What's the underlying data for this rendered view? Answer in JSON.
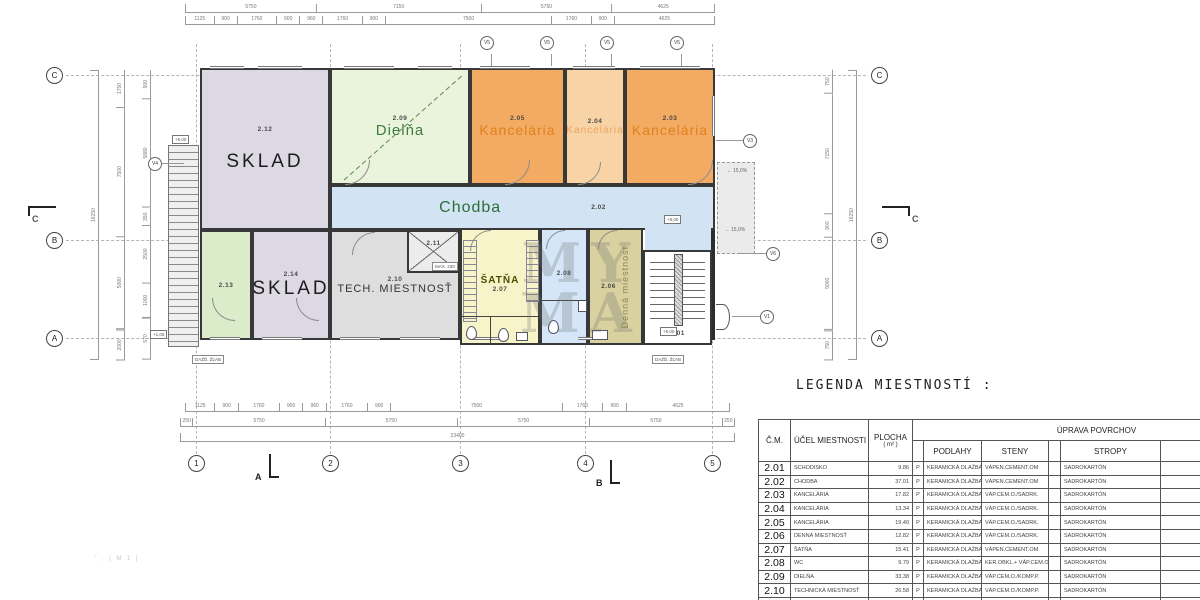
{
  "colors": {
    "kanc_dark": "#f3aa63",
    "kanc_light": "#f8d3a6",
    "chodba": "#d2e4f3",
    "dielna": "#eaf4dd",
    "sklad": "#ddd9e4",
    "tech": "#dedede",
    "satna": "#f8f4c9",
    "wc": "#d4e6f8",
    "denna": "#d9d1a0",
    "green_room": "#dbeccb"
  },
  "plan": {
    "rooms": {
      "r212": {
        "num": "2.12",
        "name": "SKLAD"
      },
      "r209": {
        "num": "2.09",
        "name": "Dielňa"
      },
      "r205": {
        "num": "2.05",
        "name": "Kancelária"
      },
      "r204": {
        "num": "2.04",
        "name": "Kancelária"
      },
      "r203": {
        "num": "2.03",
        "name": "Kancelária"
      },
      "r202": {
        "num": "2.02",
        "name": "Chodba"
      },
      "r213": {
        "num": "2.13"
      },
      "r214": {
        "num": "2.14",
        "name": "SKLAD"
      },
      "r210": {
        "num": "2.10",
        "name": "TECH. MIESTNOSŤ"
      },
      "r211": {
        "num": "2.11"
      },
      "r207": {
        "num": "2.07",
        "name": "ŠATŇA"
      },
      "r208": {
        "num": "2.08"
      },
      "r206": {
        "num": "2.06",
        "name": "Denná miestnosť"
      },
      "r201": {
        "num": "2.01"
      }
    },
    "grid": {
      "letters": [
        "C",
        "B",
        "A"
      ],
      "numbers": [
        "1",
        "2",
        "3",
        "4",
        "5"
      ]
    },
    "marks": [
      "V5",
      "V5",
      "V5",
      "V5",
      "V4",
      "V3",
      "V6",
      "V1"
    ],
    "levels": [
      "+5,00",
      "+5,00",
      "+5,00",
      "+1,00"
    ],
    "slopes": [
      "15,0%",
      "15,0%"
    ],
    "gutter_label": "DAŽĎ. ŽĽAB",
    "max_label": "MAX. 230",
    "sections": {
      "a": "A",
      "b": "B",
      "c": "C"
    }
  },
  "dims": {
    "top1": [
      {
        "t": "5750",
        "w": 23
      },
      {
        "t": "7150",
        "w": 29
      },
      {
        "t": "5750",
        "w": 23
      },
      {
        "t": "4625",
        "w": 18
      }
    ],
    "top2": [
      {
        "t": "1125",
        "w": 5
      },
      {
        "t": "900",
        "w": 4
      },
      {
        "t": "1760",
        "w": 7
      },
      {
        "t": "900",
        "w": 4
      },
      {
        "t": "960",
        "w": 4
      },
      {
        "t": "1760",
        "w": 7
      },
      {
        "t": "900",
        "w": 4
      },
      {
        "t": "7500",
        "w": 30
      },
      {
        "t": "1760",
        "w": 7
      },
      {
        "t": "900",
        "w": 4
      },
      {
        "t": "4625",
        "w": 18
      }
    ],
    "bottom1": [
      {
        "t": "1125",
        "w": 5
      },
      {
        "t": "900",
        "w": 4
      },
      {
        "t": "1760",
        "w": 7
      },
      {
        "t": "900",
        "w": 4
      },
      {
        "t": "960",
        "w": 4
      },
      {
        "t": "1760",
        "w": 7
      },
      {
        "t": "900",
        "w": 4
      },
      {
        "t": "7500",
        "w": 30
      },
      {
        "t": "1760",
        "w": 7
      },
      {
        "t": "900",
        "w": 4
      },
      {
        "t": "4625",
        "w": 18
      }
    ],
    "bottom2": [
      {
        "t": "250",
        "w": 2
      },
      {
        "t": "5750",
        "w": 23
      },
      {
        "t": "5750",
        "w": 23
      },
      {
        "t": "5750",
        "w": 23
      },
      {
        "t": "5750",
        "w": 23
      },
      {
        "t": "250",
        "w": 2
      }
    ],
    "bottom_total": [
      {
        "t": "23400",
        "w": 1
      }
    ],
    "left1": [
      {
        "t": "16250",
        "w": 1
      }
    ],
    "left2": [
      {
        "t": "1750",
        "w": 13
      },
      {
        "t": "7500",
        "w": 45
      },
      {
        "t": "5000",
        "w": 32
      },
      {
        "t": "2000",
        "w": 10
      }
    ],
    "left3": [
      {
        "t": "900",
        "w": 10
      },
      {
        "t": "5880",
        "w": 38
      },
      {
        "t": "350",
        "w": 6
      },
      {
        "t": "2500",
        "w": 20
      },
      {
        "t": "1000",
        "w": 12
      },
      {
        "t": "570",
        "w": 14
      }
    ],
    "right1": [
      {
        "t": "16250",
        "w": 1
      }
    ],
    "right2": [
      {
        "t": "750",
        "w": 8
      },
      {
        "t": "7150",
        "w": 42
      },
      {
        "t": "900",
        "w": 8
      },
      {
        "t": "5000",
        "w": 32
      },
      {
        "t": "750",
        "w": 10
      }
    ]
  },
  "watermark": {
    "line1": "MY",
    "line2": "MA"
  },
  "footnote": "' , | M 1 [",
  "legend": {
    "title": "LEGENDA MIESTNOSTÍ :",
    "headers": {
      "cm": "Č.M.",
      "ucel": "ÚČEL MIESTNOSTI",
      "plocha": "PLOCHA",
      "plocha_unit": "( m² )",
      "uprava": "ÚPRAVA POVRCHOV",
      "podlahy": "PODLAHY",
      "steny": "STENY",
      "stropy": "STROPY"
    },
    "rows": [
      {
        "cm": "2.01",
        "ucel": "SCHODISKO",
        "plocha": "9.86",
        "p": "P",
        "podlahy": "KERAMICKÁ DLAŽBA",
        "steny": "VÁPEN.CEMENT.OM",
        "stropy": "SADROKARTÓN"
      },
      {
        "cm": "2.02",
        "ucel": "CHODBA",
        "plocha": "37.01",
        "p": "P",
        "podlahy": "KERAMICKÁ DLAŽBA",
        "steny": "VÁPEN.CEMENT.OM",
        "stropy": "SADROKARTÓN"
      },
      {
        "cm": "2.03",
        "ucel": "KANCELÁRIA",
        "plocha": "17.82",
        "p": "P",
        "podlahy": "KERAMICKÁ DLAŽBA",
        "steny": "VÁP.CEM.O./SADRK.",
        "stropy": "SADROKARTÓN"
      },
      {
        "cm": "2.04",
        "ucel": "KANCELÁRIA",
        "plocha": "13.34",
        "p": "P",
        "podlahy": "KERAMICKÁ DLAŽBA",
        "steny": "VÁP.CEM.O./SADRK.",
        "stropy": "SADROKARTÓN"
      },
      {
        "cm": "2.05",
        "ucel": "KANCELÁRIA",
        "plocha": "19.40",
        "p": "P",
        "podlahy": "KERAMICKÁ DLAŽBA",
        "steny": "VÁP.CEM.O./SADRK.",
        "stropy": "SADROKARTÓN"
      },
      {
        "cm": "2.06",
        "ucel": "DENNÁ MIESTNOSŤ",
        "plocha": "12.82",
        "p": "P",
        "podlahy": "KERAMICKÁ DLAŽBA",
        "steny": "VÁP.CEM.O./SADRK.",
        "stropy": "SADROKARTÓN"
      },
      {
        "cm": "2.07",
        "ucel": "ŠATŇA",
        "plocha": "15.41",
        "p": "P",
        "podlahy": "KERAMICKÁ DLAŽBA",
        "steny": "VÁPEN.CEMENT.OM",
        "stropy": "SADROKARTÓN"
      },
      {
        "cm": "2.08",
        "ucel": "WC",
        "plocha": "9.79",
        "p": "P",
        "podlahy": "KERAMICKÁ DLAŽBA",
        "steny": "KER.OBKL.+ VÁP.CEM.OM",
        "stropy": "SADROKARTÓN"
      },
      {
        "cm": "2.09",
        "ucel": "DIELŇA",
        "plocha": "33.38",
        "p": "P",
        "podlahy": "KERAMICKÁ DLAŽBA",
        "steny": "VÁP.CEM.O./KOMP.P.",
        "stropy": "SADROKARTÓN"
      },
      {
        "cm": "2.10",
        "ucel": "TECHNICKÁ MIESTNOSŤ",
        "plocha": "26.58",
        "p": "P",
        "podlahy": "KERAMICKÁ DLAŽBA",
        "steny": "VÁP.CEM.O./KOMP.P.",
        "stropy": "SADROKARTÓN"
      },
      {
        "cm": "2.11",
        "ucel": "KOTOLŇA",
        "plocha": "4.75",
        "p": "P",
        "podlahy": "KERAMICKÁ DLAŽBA",
        "steny": "VÁP.CEM.O./KOMP.P.",
        "stropy": "SADROKARTÓN"
      }
    ]
  }
}
